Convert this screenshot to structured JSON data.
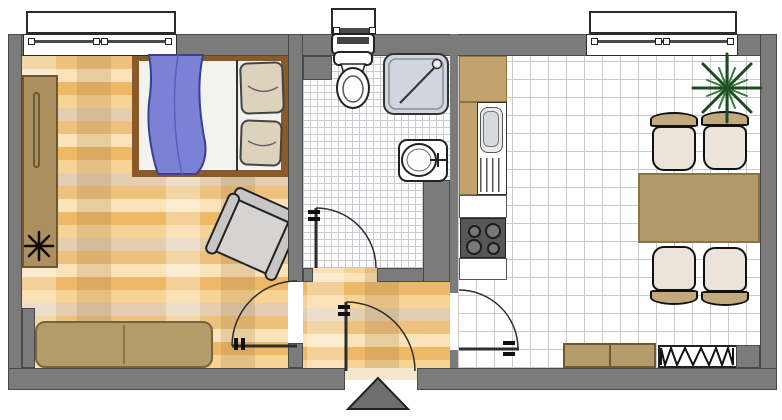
{
  "meta": {
    "kind": "floor-plan",
    "view": "top-down",
    "note": "no text labels visible in image"
  },
  "colors": {
    "wall": "#7b7b7b",
    "parquet_base": "#f1c07a",
    "bath_tile_line": "#c9cdd1",
    "kitchen_tile_line": "#cbcbcb",
    "furniture_tan": "#b59c6b",
    "bed_frame_brown": "#8a5a28",
    "blanket_blue": "#7b82d6",
    "pillow_beige": "#ddd3bd",
    "armchair_gray": "#d6d3d3",
    "stove_dark": "#575757",
    "shower_tray": "#cfd6dd",
    "chair_seat": "#ece3da",
    "chair_back": "#c2aa7c",
    "plant_green": "#1e4a24",
    "entry_marker_gray": "#6e6e6e"
  },
  "rooms": [
    {
      "id": "living-bedroom",
      "floor": "parquet",
      "furniture": [
        "window",
        "wardrobe-sideboard",
        "plant-on-sideboard",
        "double-bed-with-blanket-and-two-pillows",
        "armchair",
        "two-seat-sofa"
      ]
    },
    {
      "id": "bathroom",
      "floor": "small-white-tiles",
      "furniture": [
        "small-window",
        "toilet-with-cistern",
        "corner-shower",
        "washbasin-with-tap"
      ]
    },
    {
      "id": "hallway",
      "floor": "parquet",
      "furniture": []
    },
    {
      "id": "kitchen-dining",
      "floor": "large-white-tiles",
      "furniture": [
        "window",
        "upper-cabinet",
        "sink-unit-with-drainer",
        "worktop",
        "stove-four-burners",
        "worktop-2",
        "dining-table",
        "chair-1",
        "chair-2",
        "chair-3",
        "chair-4",
        "potted-plant",
        "sideboard-two-units",
        "radiator"
      ]
    }
  ],
  "openings": {
    "windows": [
      "living-room-window-top-left",
      "bathroom-window-top-middle",
      "kitchen-window-top-right"
    ],
    "doors": [
      "bathroom-door-swings-in",
      "living-room-door-swings-in",
      "entrance-door-bottom",
      "kitchen-door-swings-in"
    ],
    "entrance_marker": "gray-triangle-arrow-at-bottom"
  }
}
